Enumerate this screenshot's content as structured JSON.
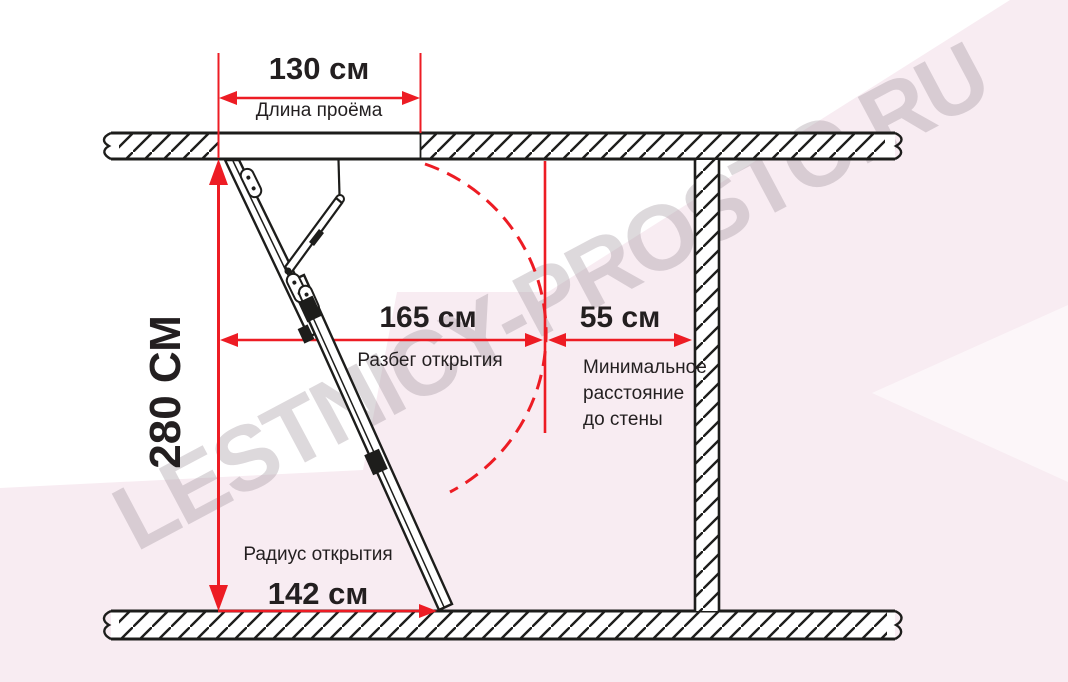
{
  "watermark": {
    "text": "LESTNICY-PROSTO.RU"
  },
  "diagram": {
    "dim_opening_length": {
      "value": "130 см",
      "label": "Длина проёма"
    },
    "dim_height": {
      "value": "280 СМ"
    },
    "dim_swing_span": {
      "value": "165 см",
      "label": "Разбег открытия"
    },
    "dim_wall_clearance": {
      "value": "55 см",
      "label_lines": [
        "Минимальное",
        "расстояние",
        "до стены"
      ]
    },
    "dim_opening_radius": {
      "value": "142 см",
      "label": "Радиус открытия"
    }
  },
  "colors": {
    "dimension_red": "#ed1c24",
    "line_black": "#1d1d1b",
    "background_pink": "#f8ecf2",
    "watermark_gray": "rgba(151,141,148,0.33)"
  }
}
